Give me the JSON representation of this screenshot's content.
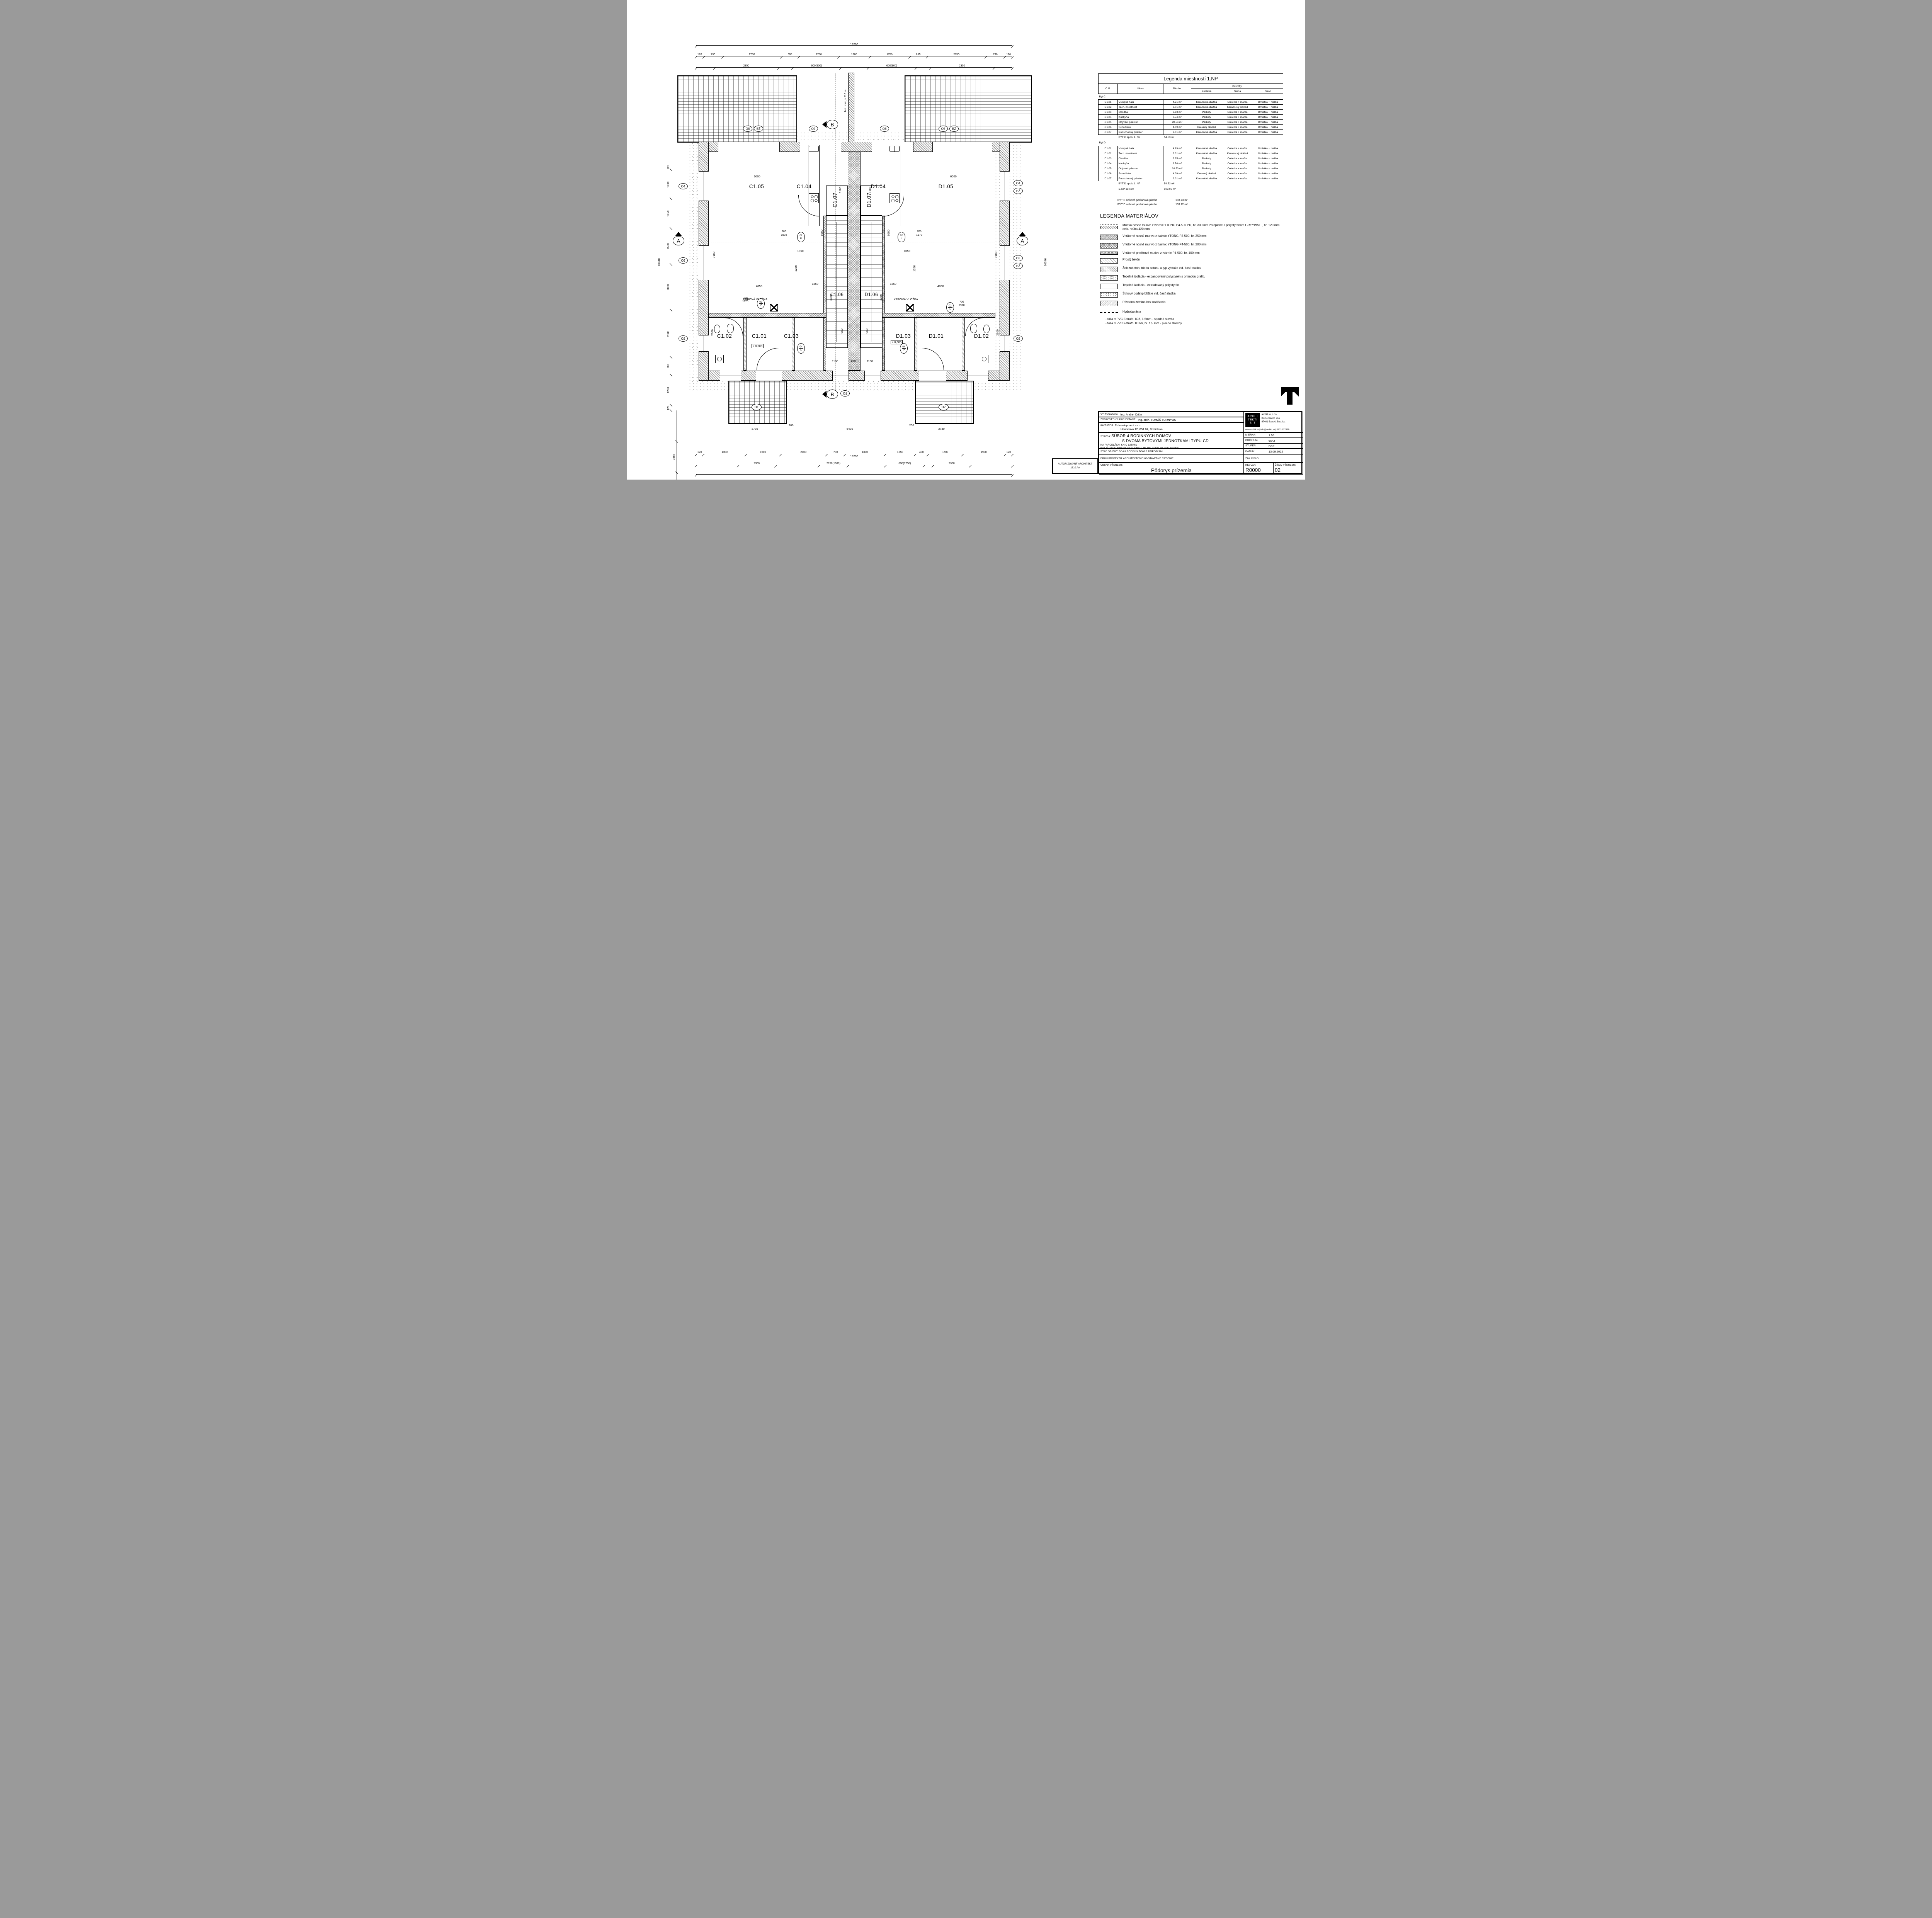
{
  "plan": {
    "rooms": [
      "C1.05",
      "C1.04",
      "D1.04",
      "D1.05",
      "C1.07",
      "D1.07",
      "C1.06",
      "D1.06",
      "C1.02",
      "C1.01",
      "C1.03",
      "D1.03",
      "D1.01",
      "D1.02"
    ],
    "markers": {
      "o1": "O1",
      "o2": "O2",
      "o3": "O3",
      "o4": "O4",
      "o5": "O5",
      "o6": "O6",
      "o7": "O7",
      "o8": "O8",
      "o9": "O9",
      "ez": "EŽ",
      "a": "A",
      "b": "B",
      "d1": "D1",
      "d2": "D2"
    },
    "doors": [
      {
        "no": "02",
        "side": "P"
      },
      {
        "no": "02",
        "side": "L"
      },
      {
        "no": "04",
        "side": "L"
      },
      {
        "no": "04",
        "side": "P"
      },
      {
        "no": "02",
        "side": "P"
      },
      {
        "no": "02",
        "side": "L"
      }
    ],
    "texts": {
      "door_w": "700",
      "door_h": "1970",
      "niche": "1050",
      "krb": "KRBOVÁ VLOŽKA",
      "zero": "± 0,000",
      "bet": "bet. múr, v. 2,0 m"
    },
    "inner": {
      "d6000": "6000",
      "d7100": "7100",
      "d4850": "4850",
      "d3100": "3100",
      "d6600": "6600",
      "d3360": "3360",
      "d1180": "1180",
      "d450": "450",
      "d900": "900",
      "d1350": "1350",
      "d1250": "1250",
      "d2300": "2300"
    },
    "dims": {
      "top_total": "13290",
      "bottom_total": "13290",
      "side_total": "10340",
      "t3730": "3730",
      "t5430": "5430",
      "t200": "200",
      "top": [
        {
          "label": "120",
          "span": 120
        },
        {
          "label": "730",
          "span": 730
        },
        {
          "label": "2750",
          "span": 2750
        },
        {
          "label": "655",
          "span": 655
        },
        {
          "label": "1750",
          "span": 1750
        },
        {
          "label": "1280",
          "span": 1280
        },
        {
          "label": "1750",
          "span": 1750
        },
        {
          "label": "655",
          "span": 655
        },
        {
          "label": "2750",
          "span": 2750
        },
        {
          "label": "730",
          "span": 730
        },
        {
          "label": "120",
          "span": 120
        }
      ],
      "top2": [
        {
          "label": "",
          "span": 850
        },
        {
          "label": "2350",
          "span": 2750
        },
        {
          "label": "",
          "span": 655
        },
        {
          "label": "600(900)",
          "span": 1750
        },
        {
          "label": "",
          "span": 1280
        },
        {
          "label": "600(900)",
          "span": 1750
        },
        {
          "label": "",
          "span": 655
        },
        {
          "label": "2350",
          "span": 2750
        },
        {
          "label": "",
          "span": 850
        }
      ],
      "bottom": [
        {
          "label": "120",
          "span": 120
        },
        {
          "label": "1900",
          "span": 1900
        },
        {
          "label": "1500",
          "span": 1500
        },
        {
          "label": "2100",
          "span": 2100
        },
        {
          "label": "700",
          "span": 700
        },
        {
          "label": "1800",
          "span": 1800
        },
        {
          "label": "1250",
          "span": 1250
        },
        {
          "label": "400",
          "span": 400
        },
        {
          "label": "1500",
          "span": 1500
        },
        {
          "label": "1900",
          "span": 1900
        },
        {
          "label": "120",
          "span": 120
        }
      ],
      "bottom2": [
        {
          "label": "",
          "span": 2020
        },
        {
          "label": "2350",
          "span": 1500
        },
        {
          "label": "",
          "span": 2100
        },
        {
          "label": "2150(1600)",
          "span": 700
        },
        {
          "label": "",
          "span": 1800
        },
        {
          "label": "600(1750)",
          "span": 1250
        },
        {
          "label": "",
          "span": 400
        },
        {
          "label": "2350",
          "span": 1500
        },
        {
          "label": "",
          "span": 2020
        }
      ],
      "left": [
        {
          "label": "120",
          "span": 120
        },
        {
          "label": "1230",
          "span": 1230
        },
        {
          "label": "1250",
          "span": 1250
        },
        {
          "label": "1560",
          "span": 1560
        },
        {
          "label": "2000",
          "span": 2000
        },
        {
          "label": "2080",
          "span": 2080
        },
        {
          "label": "700",
          "span": 700
        },
        {
          "label": "1280",
          "span": 1280
        },
        {
          "label": "120",
          "span": 120
        }
      ],
      "left2": [
        {
          "label": "",
          "span": 1350
        },
        {
          "label": "2350",
          "span": 1250
        },
        {
          "label": "",
          "span": 1560
        },
        {
          "label": "1500(850)",
          "span": 2000
        },
        {
          "label": "",
          "span": 2080
        },
        {
          "label": "1500(850)",
          "span": 700
        },
        {
          "label": "",
          "span": 1400
        }
      ],
      "right": [
        {
          "label": "120",
          "span": 120
        },
        {
          "label": "1230",
          "span": 1230
        },
        {
          "label": "1250",
          "span": 1250
        },
        {
          "label": "1560",
          "span": 1560
        },
        {
          "label": "2000",
          "span": 2000
        },
        {
          "label": "2080",
          "span": 2080
        },
        {
          "label": "700",
          "span": 700
        },
        {
          "label": "980",
          "span": 980
        },
        {
          "label": "300",
          "span": 300
        },
        {
          "label": "120",
          "span": 120
        }
      ],
      "right2": [
        {
          "label": "",
          "span": 1350
        },
        {
          "label": "2350",
          "span": 1250
        },
        {
          "label": "",
          "span": 1560
        },
        {
          "label": "1500(850)",
          "span": 2000
        },
        {
          "label": "",
          "span": 2080
        },
        {
          "label": "1500(850)",
          "span": 700
        },
        {
          "label": "",
          "span": 1400
        }
      ]
    }
  },
  "legend": {
    "title": "Legenda miestností 1.NP",
    "headers": {
      "cm": "Č.M.",
      "nazov": "Názov",
      "plocha": "Plocha",
      "povrchy": "Povrchy",
      "podlaha": "Podlaha",
      "stena": "Stena",
      "strop": "Strop"
    },
    "byt_c": {
      "label": "Byt C",
      "rows": [
        {
          "cm": "C1.01",
          "nazov": "Vstupná hala",
          "plocha": "4.21 m²",
          "podlaha": "Keramická dlažba",
          "stena": "Omietka + maľba",
          "strop": "Omietka + maľba"
        },
        {
          "cm": "C1.02",
          "nazov": "Tech. miestnosť",
          "plocha": "3.01 m²",
          "podlaha": "Keramická dlažba",
          "stena": "Keramický obklad",
          "strop": "Omietka + maľba"
        },
        {
          "cm": "C1.03",
          "nazov": "Chodba",
          "plocha": "3.93 m²",
          "podlaha": "Parkety",
          "stena": "Omietka + maľba",
          "strop": "Omietka + maľba"
        },
        {
          "cm": "C1.04",
          "nazov": "Kuchyňa",
          "plocha": "8.74 m²",
          "podlaha": "Parkety",
          "stena": "Omietka + maľba",
          "strop": "Omietka + maľba"
        },
        {
          "cm": "C1.05",
          "nazov": "Obývací priestor",
          "plocha": "28.54 m²",
          "podlaha": "Parkety",
          "stena": "Omietka + maľba",
          "strop": "Omietka + maľba"
        },
        {
          "cm": "C1.06",
          "nazov": "Schodisko",
          "plocha": "4.09 m²",
          "podlaha": "Drevený obklad",
          "stena": "Omietka + maľba",
          "strop": "Omietka + maľba"
        },
        {
          "cm": "C1.07",
          "nazov": "Podschodný priestor",
          "plocha": "2.01 m²",
          "podlaha": "Keramická dlažba",
          "stena": "Omietka + maľba",
          "strop": "Omietka + maľba"
        }
      ],
      "sum_label": "BYT C spolu 1. NP",
      "sum_value": "54.53 m²"
    },
    "byt_d": {
      "label": "Byt D",
      "rows": [
        {
          "cm": "D1.01",
          "nazov": "Vstupná hala",
          "plocha": "4.19 m²",
          "podlaha": "Keramická dlažba",
          "stena": "Omietka + maľba",
          "strop": "Omietka + maľba"
        },
        {
          "cm": "D1.02",
          "nazov": "Tech. miestnosť",
          "plocha": "3.01 m²",
          "podlaha": "Keramická dlažba",
          "stena": "Keramický obklad",
          "strop": "Omietka + maľba"
        },
        {
          "cm": "D1.03",
          "nazov": "Chodba",
          "plocha": "3.95 m²",
          "podlaha": "Parkety",
          "stena": "Omietka + maľba",
          "strop": "Omietka + maľba"
        },
        {
          "cm": "D1.04",
          "nazov": "Kuchyňa",
          "plocha": "8.74 m²",
          "podlaha": "Parkety",
          "stena": "Omietka + maľba",
          "strop": "Omietka + maľba"
        },
        {
          "cm": "D1.05",
          "nazov": "Obývací priestor",
          "plocha": "28.53 m²",
          "podlaha": "Parkety",
          "stena": "Omietka + maľba",
          "strop": "Omietka + maľba"
        },
        {
          "cm": "D1.06",
          "nazov": "Schodisko",
          "plocha": "4.09 m²",
          "podlaha": "Drevený obklad",
          "stena": "Omietka + maľba",
          "strop": "Omietka + maľba"
        },
        {
          "cm": "D1.07",
          "nazov": "Podschodný priestor",
          "plocha": "2.01 m²",
          "podlaha": "Keramická dlažba",
          "stena": "Omietka + maľba",
          "strop": "Omietka + maľba"
        }
      ],
      "sum_label": "BYT D spolu 1. NP",
      "sum_value": "54.52 m²"
    },
    "total_label": "1. NP celkom",
    "total_value": "109.05 m²",
    "areas": [
      {
        "label": "BYT C celková podlahová plocha",
        "value": "103.73 m²"
      },
      {
        "label": "BYT D celková podlahová plocha",
        "value": "103.72 m²"
      }
    ]
  },
  "materials": {
    "title": "LEGENDA MATERIÁLOV",
    "items": [
      {
        "p": "ext",
        "text": "Murivo nosné murivo z tvárnic YTONG P4-500 PD, hr. 300 mm zateplené s polystyrénom GREYWALL, hr. 120 mm, celk. hrúba 420 mm"
      },
      {
        "p": "c250",
        "text": "Vnútorné nosné murivo z tvárnic YTONG P2-500, hr. 250 mm"
      },
      {
        "p": "c200",
        "text": "Vnútorné nosné murivo z tvárnic YTONG P4-500, hr. 200 mm"
      },
      {
        "p": "c100",
        "text": "Vnútorné priečkové murivo z tvárnic P4-500, hr. 100 mm"
      },
      {
        "p": "beton",
        "text": "Prostý betón"
      },
      {
        "p": "zb",
        "text": "Železobetón, triedu betónu a typ výstuže viď. časť statika"
      },
      {
        "p": "eps",
        "text": "Tepelná izolácia - expandovaný polystyrén s prísadou grafitu"
      },
      {
        "p": "xps",
        "text": "Tepelná izolácia - extrudovaný polystyrén"
      },
      {
        "p": "strk",
        "text": "Štrkový podsyp bližšie viď. časť statika"
      },
      {
        "p": "zem",
        "text": "Pôvodná zemina bez rozlíšenia"
      }
    ],
    "hydro": {
      "title": "Hydroizolácia",
      "lines": [
        "- fólia mPVC Fatrafol 803, 1,5mm - spodná stavba",
        "- fólia mPVC Fatrafol 807/V, hr. 1,5 mm - ploché strechy"
      ]
    }
  },
  "titleblock": {
    "vypracoval_label": "VYPRACOVAL:",
    "vypracoval": "Ing. Andrej Oršin",
    "zodpovedny_label": "ZODPOVEDNÝ PROJEKTANT:",
    "zodpovedny": "Ing. arch. TOMÁŠ TORNYOS",
    "investor_label": "INVESTOR:",
    "investor": "R development s.r.o.",
    "investor2": "Haannova 12, 851 04, Bratislava",
    "stavba_label": "STAVBA:",
    "stavba1": "SÚBOR 4 RODINNÝCH DOMOV",
    "stavba2": "S DVOMA BYTOVÝMI JEDNOTKAMI TYPU CD",
    "parcely": "NA PARCELÁCH:  KN-C 133/461",
    "uzemie": "KAT. ÚZEMIE: MILOSLAVOV, OBEC: MILOSLAVOV, OKRES: SENEC",
    "objekt": "STAV. OBJEKT: SO-01 RODINNÝ DOM S PRÍPOJKAMI",
    "druh": "DRUH PROJEKTU:  ARCHITEKTONICKO-STAVEBNÉ RIEŠENIE",
    "obsah_label": "OBSAH VÝKRESU:",
    "obsah": "Pôdorys prízemia",
    "mierka_label": "MIERKA:",
    "mierka": "1:50",
    "pocet_label": "POČET A4:",
    "pocet": "6xA4",
    "stupen_label": "STUPEŇ:",
    "stupen": "DSP",
    "datum_label": "DÁTUM:",
    "datum": "13.09.2022",
    "zakcislo_label": "ZÁK.ČÍSLO:",
    "zakcislo": "",
    "revizia_label": "REVÍZIA:",
    "revizia": "R0000",
    "cislo_label": "ČÍSLO VÝKRESU:",
    "cislo": "02",
    "autorizovany1": "AUTORIZOVANÝ ARCHITEKT",
    "autorizovany2": "1810 AA",
    "logo": [
      "ARCHI",
      "TEKTI",
      "T::T"
    ],
    "firm": [
      "architt.sk, s.r.o.",
      "Komenského 24A",
      "97401 Banská Bystrica"
    ],
    "contact": "www.architt.sk | info@architt.sk | 0903 622366"
  }
}
